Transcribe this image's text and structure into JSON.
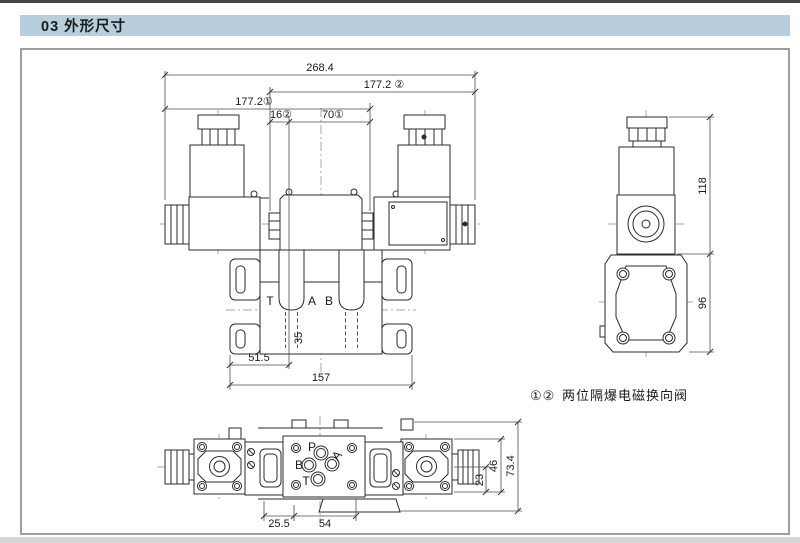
{
  "header": {
    "number": "03",
    "title": "外形尺寸"
  },
  "caption": {
    "prefix": "①②",
    "text": "两位隔爆电磁换向阀"
  },
  "front_view": {
    "dims": {
      "overall_width": "268.4",
      "width_b": "177.2 ②",
      "width_a": "177.2①",
      "offset_b": "16②",
      "offset_a": "70①",
      "port_depth": "35",
      "hole_offset": "51.5",
      "plate_width": "157"
    },
    "ports": {
      "t": "T",
      "a": "A",
      "b": "B"
    }
  },
  "side_view": {
    "dims": {
      "height_upper": "118",
      "height_lower": "96"
    }
  },
  "bottom_view": {
    "dims": {
      "offset_left": "25.5",
      "spacing": "54",
      "half_height": "23",
      "flange_height": "46",
      "overall_height": "73.4"
    },
    "ports": {
      "p": "P",
      "a": "A",
      "b": "B",
      "t": "T"
    }
  },
  "colors": {
    "header_band": "#b8cedd",
    "line": "#2b2b2b",
    "centerline": "#8a8a8a",
    "box_border": "#9f9f9f",
    "bottom_strip": "#d6d6d6"
  }
}
